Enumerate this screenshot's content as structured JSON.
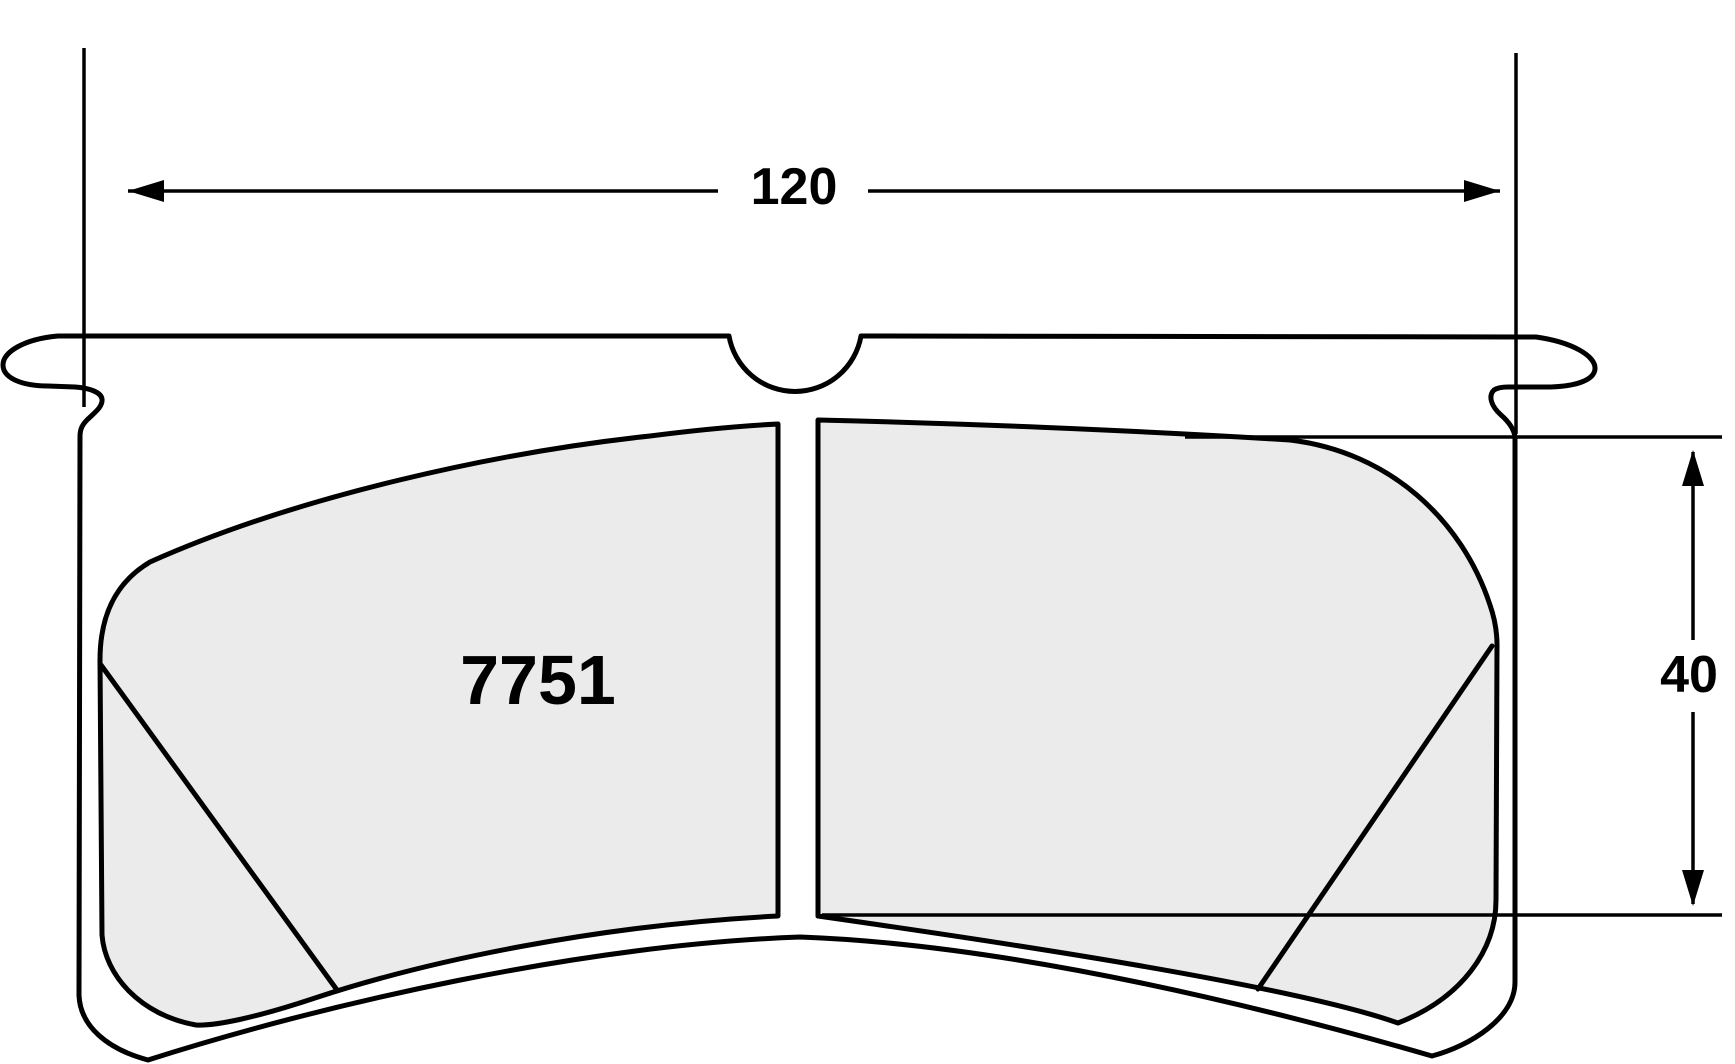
{
  "part": {
    "number": "7751"
  },
  "dimensions": {
    "width": {
      "value": "120"
    },
    "height": {
      "value": "40"
    }
  },
  "colors": {
    "line": "#000000",
    "pad_fill": "#ebebeb",
    "background": "#ffffff"
  }
}
